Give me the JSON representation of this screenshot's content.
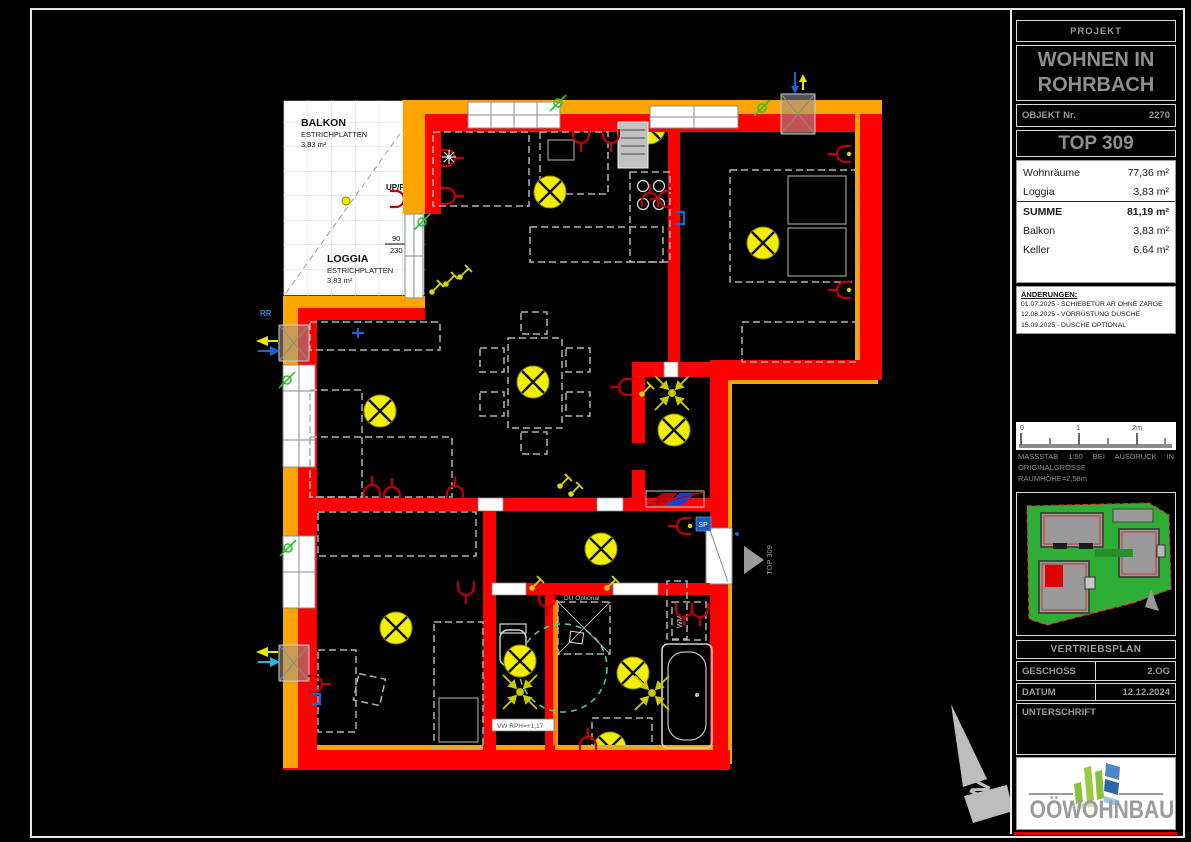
{
  "title_block": {
    "projekt_label": "PROJEKT",
    "project_name": "WOHNEN IN ROHRBACH",
    "objekt_label": "OBJEKT Nr.",
    "objekt_nr": "2270",
    "top_label": "TOP 309",
    "areas": {
      "rows": [
        {
          "label": "Wohnräume",
          "value": "77,36 m²"
        },
        {
          "label": "Loggia",
          "value": "3,83 m²"
        },
        {
          "label": "SUMME",
          "value": "81,19 m²"
        },
        {
          "label": "Balkon",
          "value": "3,83 m²"
        },
        {
          "label": "Keller",
          "value": "6,64 m²"
        }
      ]
    },
    "aenderungen": {
      "heading": "ÄNDERUNGEN:",
      "items": [
        "01.07.2025 - SCHIEBETÜR AR OHNE ZARGE",
        "12.08.2025 - VORRÜSTUNG DUSCHE",
        "15.09.2025 - DUSCHE OPTIONAL"
      ]
    },
    "scale": {
      "tick0": "0",
      "tick1": "1",
      "tick2": "2m",
      "note_line1": "MASSSTAB 1:50 BEI AUSDRUCK IN",
      "note_line2": "ORIGINALGRÖSSE",
      "note_line3": "RAUMHÖHE=2,58m"
    },
    "vertriebsplan": "VERTRIEBSPLAN",
    "geschoss_label": "GESCHOSS",
    "geschoss_value": "2.OG",
    "datum_label": "DATUM",
    "datum_value": "12.12.2024",
    "unterschrift_label": "UNTERSCHRIFT",
    "logo_text": "OÖWOHNBAU"
  },
  "plan": {
    "balkon": {
      "name": "BALKON",
      "material": "ESTRICHPLATTEN",
      "area": "3,83 m²"
    },
    "loggia": {
      "name": "LOGGIA",
      "material": "ESTRICHPLATTEN",
      "area": "3,83 m²"
    },
    "upfr": "UP/FR",
    "door_dim": {
      "width": "90",
      "height": "230"
    },
    "rr": "RR",
    "du_optional": "DU Optional",
    "wm": "WM",
    "vw_label": "VW RPH=+1,17",
    "sp": "SP",
    "entrance": "TOP 309",
    "north": "N"
  },
  "colors": {
    "wall_red": "#ff0000",
    "insulation_orange": "#ffa500",
    "light_yellow": "#f2ef00",
    "symbol_red": "#c00000",
    "contact_green": "#2fbf2f",
    "shower_circle_green": "#4fc98f",
    "site_green": "#2eae35",
    "logo_green": "#9cca3e",
    "logo_blue": "#2d66a8"
  }
}
